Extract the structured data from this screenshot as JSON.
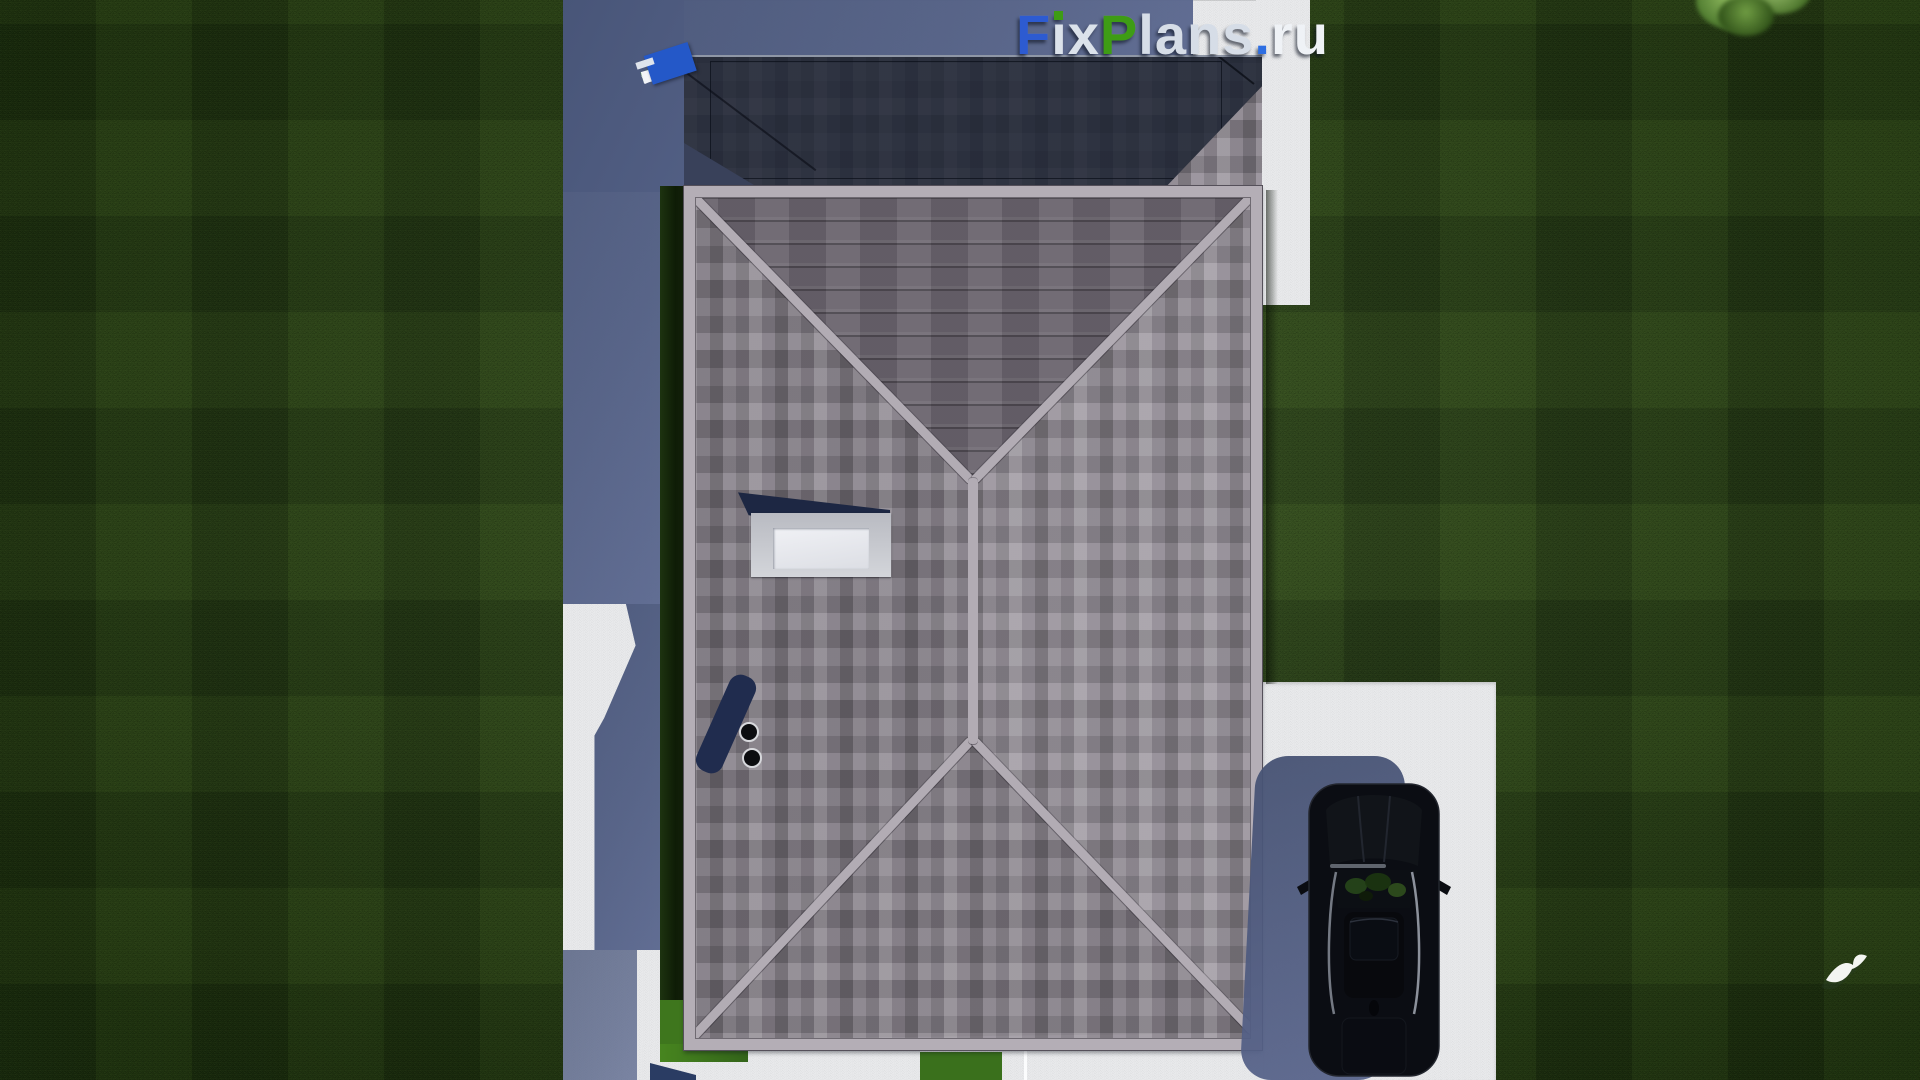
{
  "watermark": {
    "full_text": "FixPlans.ru",
    "parts": [
      {
        "text": "F",
        "color": "#2d5bd1"
      },
      {
        "text": "ix",
        "color": "#dbe2eb"
      },
      {
        "text": "P",
        "color": "#3e9c15"
      },
      {
        "text": "lans",
        "color": "#d6dde7"
      },
      {
        "text": ".",
        "color": "#2e6ee2"
      },
      {
        "text": "ru",
        "color": "#eff2f6"
      }
    ]
  },
  "palette": {
    "grass": "#223a11",
    "grass_sunlit": "#3e761d",
    "paving_white": "#e8e9eb",
    "cast_shadow_blue": "#52607f",
    "roof_shingle_light": "#9b959b",
    "roof_shingle_dark": "#767077",
    "roof_north_face": "#6a646e",
    "roof_dark_section": "#1a2130",
    "ridge_cap": "#b2acb4",
    "car_body": "#0b0d13",
    "skylight_frame": "#c9cbd1",
    "tape_green": "#35a31a",
    "tape_blue": "#2458c8"
  },
  "scene": {
    "view": "aerial top-down 3d render of hip-roof house",
    "objects": [
      "lawn",
      "mowing-stripes",
      "white-paving",
      "house-shadow",
      "hip-roof",
      "dark-roof-section",
      "roof-skylight",
      "roof-vent-pipes",
      "hedge-strip",
      "driveway",
      "parked-car",
      "car-shadow",
      "tree-canopy",
      "flying-bird",
      "measuring-tape",
      "logo-watermark"
    ]
  }
}
